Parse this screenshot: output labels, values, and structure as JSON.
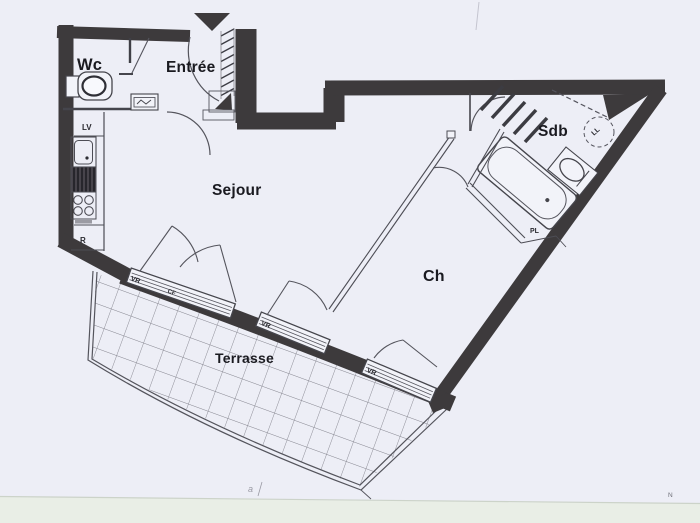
{
  "document_type": "apartment floor plan scan",
  "rooms": {
    "wc": "Wc",
    "entree": "Entrée",
    "sejour": "Sejour",
    "sdb": "Sdb",
    "ch": "Ch",
    "terrasse": "Terrasse"
  },
  "fixtures": {
    "dishwasher": "LV",
    "fridge": "R",
    "washing_machine": "LL",
    "closet": "PL"
  },
  "window_labels": {
    "shutter": "VR",
    "window_a_mark": "CF"
  },
  "margin_marks": {
    "north": "N",
    "handwritten": "a"
  },
  "colors": {
    "paper": "#edeef6",
    "wall": "#3d3a3c",
    "line": "#54545c",
    "label": "#1a1a20",
    "grid": "#84848e",
    "bottom_strip": "#e9eee6",
    "strip_line": "#ccd3c9"
  }
}
